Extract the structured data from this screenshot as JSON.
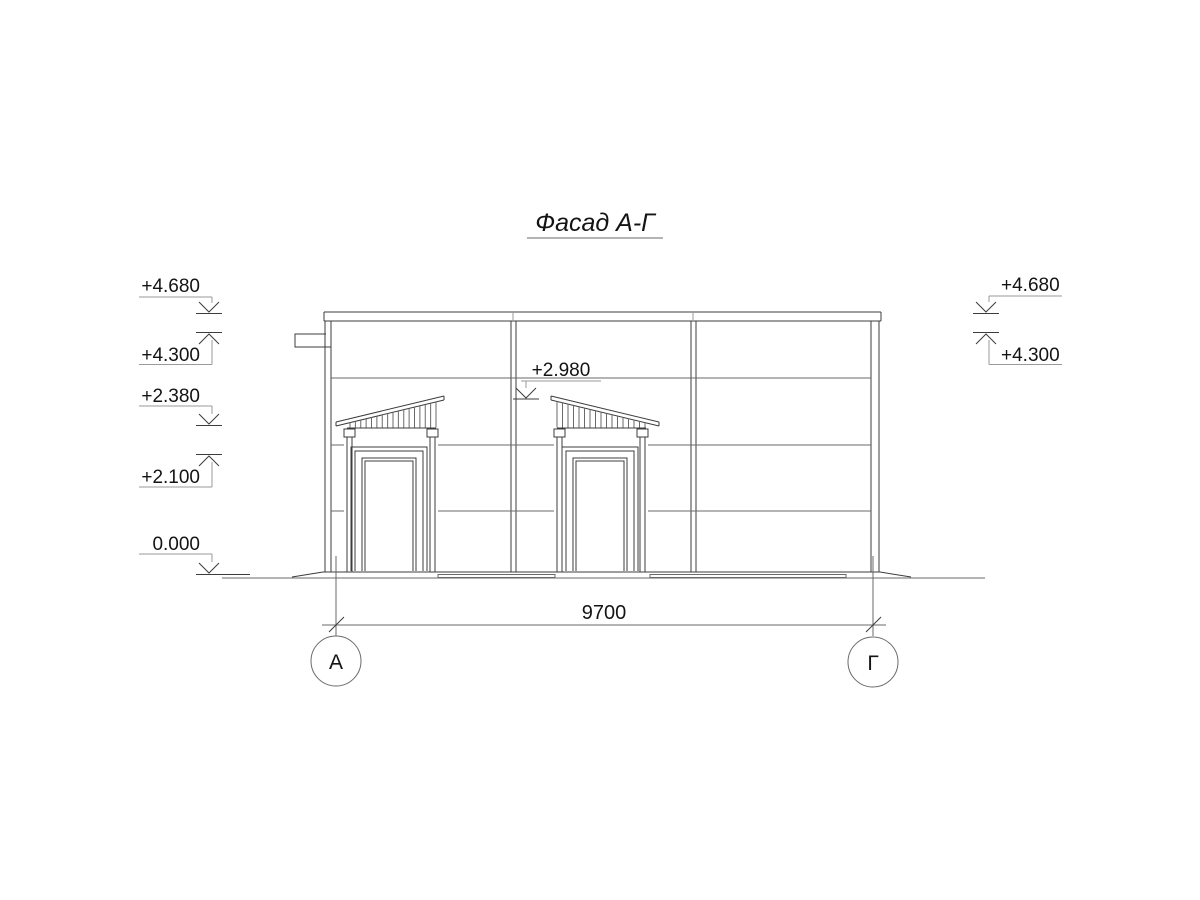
{
  "drawing_title": {
    "text": "Фасад А-Г"
  },
  "elevation_marks": {
    "left": [
      {
        "value": "+4.680",
        "direction": "down"
      },
      {
        "value": "+4.300",
        "direction": "up"
      },
      {
        "value": "+2.380",
        "direction": "down"
      },
      {
        "value": "+2.100",
        "direction": "up"
      },
      {
        "value": "0.000",
        "direction": "down"
      }
    ],
    "right": [
      {
        "value": "+4.680",
        "direction": "down"
      },
      {
        "value": "+4.300",
        "direction": "up"
      }
    ],
    "center": {
      "value": "+2.980",
      "direction": "down"
    }
  },
  "dimension": {
    "value": "9700"
  },
  "axes": {
    "left": "А",
    "right": "Г"
  },
  "colors": {
    "background": "#ffffff",
    "ink": "#3c3c3c",
    "light_line": "#9a9a9a",
    "text": "#141414"
  }
}
